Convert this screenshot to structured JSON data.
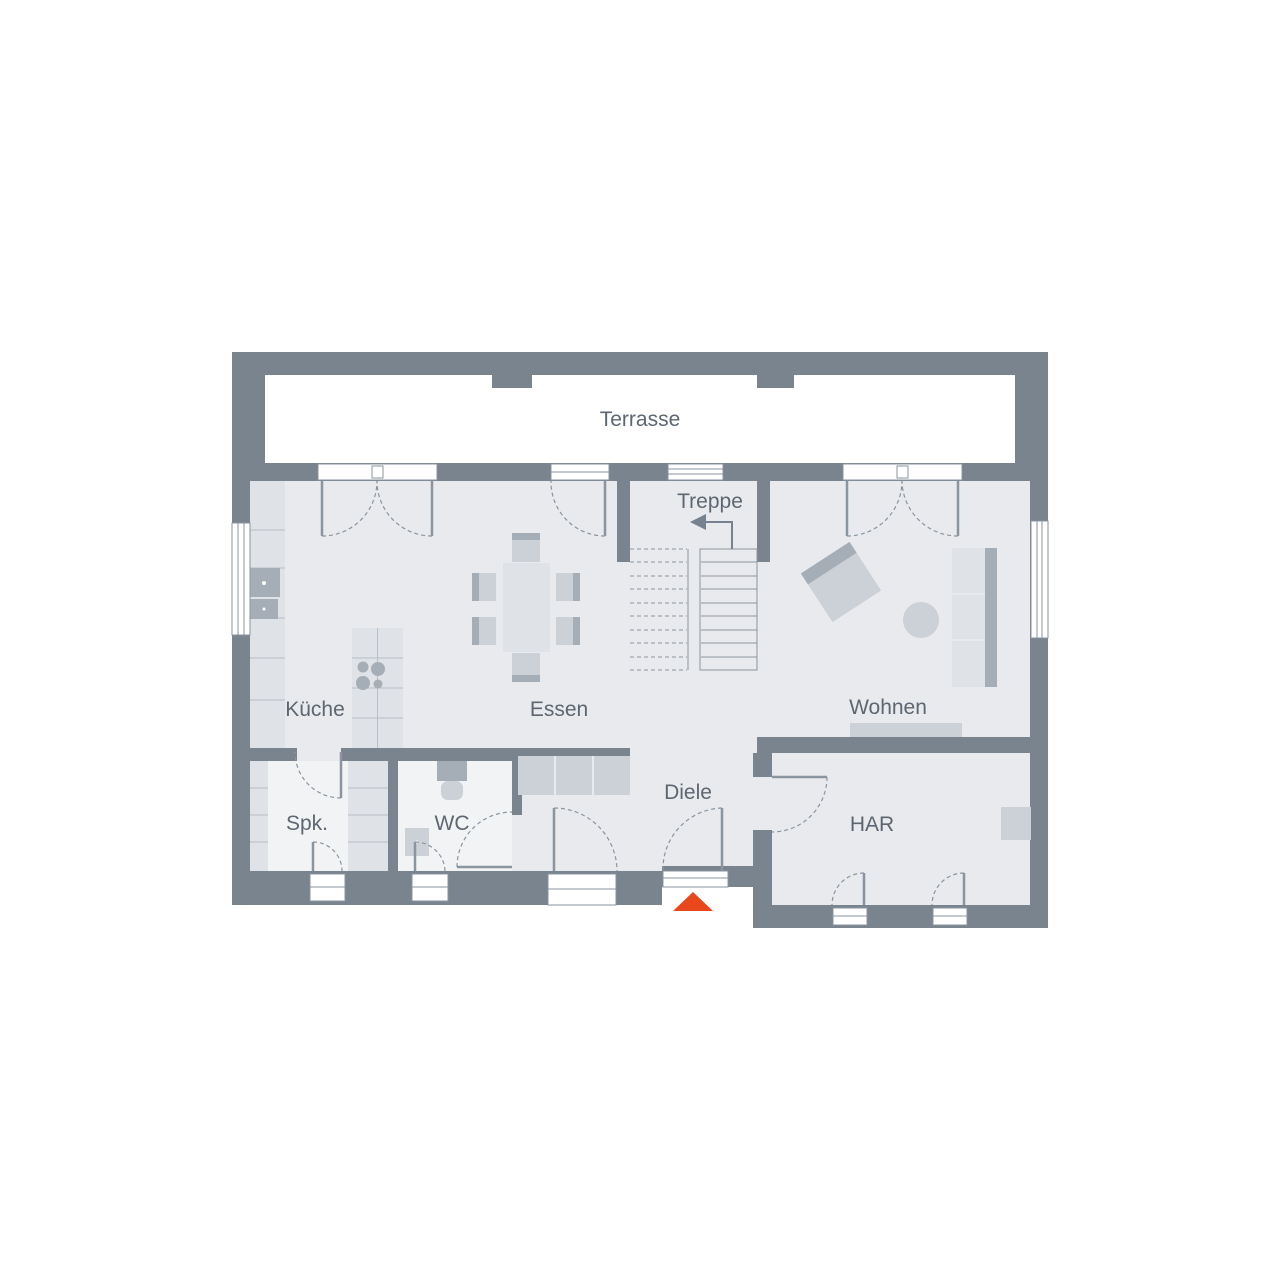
{
  "labels": {
    "terrasse": "Terrasse",
    "treppe": "Treppe",
    "kueche": "Küche",
    "essen": "Essen",
    "wohnen": "Wohnen",
    "spk": "Spk.",
    "wc": "WC",
    "diele": "Diele",
    "har": "HAR"
  },
  "rooms": [
    "Terrasse",
    "Treppe",
    "Küche",
    "Essen",
    "Wohnen",
    "Spk.",
    "WC",
    "Diele",
    "HAR"
  ],
  "colors": {
    "wall": "#79848f",
    "floor": "#e8eaed",
    "floor2": "#f2f3f5",
    "white": "#ffffff",
    "furn1": "#dfe2e6",
    "furn2": "#ccd1d7",
    "furn3": "#a5adb7",
    "line": "#8b95a0",
    "accent": "#e8481b",
    "text": "#5d6671"
  },
  "entrance_marker": "orange-triangle"
}
